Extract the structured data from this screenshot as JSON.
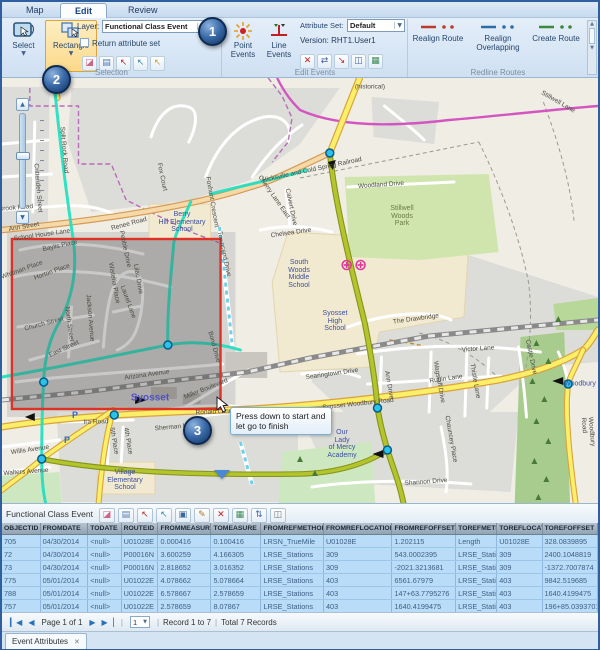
{
  "ribbon": {
    "tabs": [
      {
        "label": "Map"
      },
      {
        "label": "Edit"
      },
      {
        "label": "Review"
      }
    ],
    "select_label": "Select",
    "rectangle_label": "Rectangle",
    "layer_label": "Layer:",
    "layer_value": "Functional Class Event",
    "return_attribute_set": "Return attribute set",
    "selection_group": "Selection",
    "point_events_label": "Point Events",
    "line_events_label": "Line Events",
    "attribute_set_label": "Attribute Set:",
    "attribute_set_value": "Default",
    "version_label": "Version: RHT1.User1",
    "edit_events_group": "Edit Events",
    "selection_icons": [
      {
        "name": "clear-selection-icon",
        "glyph": "◪",
        "color": "#cc6688"
      },
      {
        "name": "attribute-table-icon",
        "glyph": "▤",
        "color": "#4a7ab0"
      },
      {
        "name": "select-by-attribute-icon",
        "glyph": "↖",
        "color": "#b03030"
      },
      {
        "name": "select-by-location-icon",
        "glyph": "↖",
        "color": "#3388aa"
      },
      {
        "name": "selection-options-icon",
        "glyph": "↖",
        "color": "#caa030"
      }
    ],
    "edit_icons": [
      {
        "name": "split-event-icon",
        "glyph": "✕",
        "color": "#c02020"
      },
      {
        "name": "merge-event-icon",
        "glyph": "⇄",
        "color": "#4466aa"
      },
      {
        "name": "snap-event-icon",
        "glyph": "↘",
        "color": "#c02020"
      },
      {
        "name": "event-window-icon",
        "glyph": "◫",
        "color": "#4466aa"
      },
      {
        "name": "event-grid-icon",
        "glyph": "▦",
        "color": "#3a8a5a"
      }
    ],
    "redline": {
      "group": "Redline Routes",
      "items": [
        {
          "label": "Realign Route",
          "color": "#c0392b"
        },
        {
          "label": "Realign Overlapping",
          "color": "#2e6da4"
        },
        {
          "label": "Create Route",
          "color": "#3a8a3a"
        }
      ]
    }
  },
  "callouts": [
    {
      "n": "1"
    },
    {
      "n": "2"
    },
    {
      "n": "3"
    }
  ],
  "map": {
    "tooltip": "Press down to start and let go to finish",
    "place_labels": [
      {
        "text": "Syosset",
        "x": 148,
        "y": 320,
        "cls": "city"
      },
      {
        "text": "Berry\nHill Elementary\nSchool",
        "x": 180,
        "y": 144
      },
      {
        "text": "South\nWoods\nMiddle\nSchool",
        "x": 297,
        "y": 196
      },
      {
        "text": "Syosset\nHigh\nSchool",
        "x": 333,
        "y": 243
      },
      {
        "text": "Stillwell\nWoods\nPark",
        "x": 400,
        "y": 138,
        "cls": "park"
      },
      {
        "text": "Our\nLady\nof Mercy\nAcademy",
        "x": 340,
        "y": 366
      },
      {
        "text": "Village\nElementary\nSchool",
        "x": 123,
        "y": 402
      },
      {
        "text": "Woodbury",
        "x": 578,
        "y": 306
      },
      {
        "text": "P",
        "x": 73,
        "y": 337,
        "cls": "pk"
      },
      {
        "text": "P",
        "x": 65,
        "y": 362,
        "cls": "pk"
      }
    ],
    "street_labels": [
      {
        "text": "Fox Court",
        "x": 160,
        "y": 99,
        "rot": 78
      },
      {
        "text": "Foxhunt Crescent",
        "x": 210,
        "y": 124,
        "rot": 80
      },
      {
        "text": "Cherry Lane East",
        "x": 272,
        "y": 119,
        "rot": 55
      },
      {
        "text": "Pebble Drive",
        "x": 123,
        "y": 171,
        "rot": 78
      },
      {
        "text": "Renee Road",
        "x": 127,
        "y": 146,
        "rot": -15
      },
      {
        "text": "School House Lane",
        "x": 40,
        "y": 157,
        "rot": -8
      },
      {
        "text": "Ann Street",
        "x": 22,
        "y": 149,
        "rot": -10
      },
      {
        "text": "Crittenden Street",
        "x": 36,
        "y": 110,
        "rot": 85
      },
      {
        "text": "Brook Road",
        "x": 14,
        "y": 130,
        "rot": -5
      },
      {
        "text": "Baylis Place",
        "x": 58,
        "y": 168,
        "rot": -12
      },
      {
        "text": "Horton Place",
        "x": 50,
        "y": 194,
        "rot": -20
      },
      {
        "text": "Whitman Place",
        "x": 20,
        "y": 192,
        "rot": -20
      },
      {
        "text": "Church Street",
        "x": 42,
        "y": 246,
        "rot": -15
      },
      {
        "text": "North Street",
        "x": 67,
        "y": 246,
        "rot": 82
      },
      {
        "text": "East Street",
        "x": 62,
        "y": 271,
        "rot": -25
      },
      {
        "text": "Jackson Avenue",
        "x": 88,
        "y": 240,
        "rot": 85
      },
      {
        "text": "Wisteria Place",
        "x": 112,
        "y": 205,
        "rot": 80
      },
      {
        "text": "Lilac Drive",
        "x": 136,
        "y": 201,
        "rot": 80
      },
      {
        "text": "Laurel Lane",
        "x": 126,
        "y": 224,
        "rot": 70
      },
      {
        "text": "Arizona Avenue",
        "x": 145,
        "y": 297,
        "rot": -8
      },
      {
        "text": "Miller Boulevard",
        "x": 204,
        "y": 311,
        "rot": -22
      },
      {
        "text": "Bond Drive",
        "x": 212,
        "y": 269,
        "rot": 75
      },
      {
        "text": "Townsend Drive",
        "x": 222,
        "y": 176,
        "rot": 78
      },
      {
        "text": "Chelsea Drive",
        "x": 289,
        "y": 155,
        "rot": -8
      },
      {
        "text": "Calvert Drive",
        "x": 289,
        "y": 129,
        "rot": 78
      },
      {
        "text": "Woodland Drive",
        "x": 379,
        "y": 107,
        "rot": -4
      },
      {
        "text": "The Drawbridge",
        "x": 414,
        "y": 241,
        "rot": -8
      },
      {
        "text": "Victor Lane",
        "x": 476,
        "y": 271,
        "rot": -4
      },
      {
        "text": "Rubin Lane",
        "x": 444,
        "y": 301,
        "rot": -8
      },
      {
        "text": "Ann Drive",
        "x": 387,
        "y": 307,
        "rot": 80
      },
      {
        "text": "Wagstaff Drive",
        "x": 437,
        "y": 304,
        "rot": 80
      },
      {
        "text": "Thistle Lane",
        "x": 473,
        "y": 303,
        "rot": 80
      },
      {
        "text": "Castle Drive",
        "x": 529,
        "y": 279,
        "rot": 78
      },
      {
        "text": "Searingtown Drive",
        "x": 330,
        "y": 296,
        "rot": -8
      },
      {
        "text": "Syosset Woodbury Road",
        "x": 356,
        "y": 326,
        "rot": -6
      },
      {
        "text": "Shannon Drive",
        "x": 424,
        "y": 404,
        "rot": -4
      },
      {
        "text": "Chauncey Place",
        "x": 449,
        "y": 361,
        "rot": 80
      },
      {
        "text": "Willis Avenue",
        "x": 28,
        "y": 372,
        "rot": -8
      },
      {
        "text": "Walters Avenue",
        "x": 24,
        "y": 394,
        "rot": -4
      },
      {
        "text": "Ira Road",
        "x": 94,
        "y": 344,
        "rot": -2
      },
      {
        "text": "5th Place",
        "x": 112,
        "y": 363,
        "rot": 80
      },
      {
        "text": "4th Place",
        "x": 126,
        "y": 363,
        "rot": 80
      },
      {
        "text": "Sherman Lane",
        "x": 174,
        "y": 349,
        "rot": -5
      },
      {
        "text": "Ronald Lane",
        "x": 212,
        "y": 334,
        "rot": -3
      },
      {
        "text": "Hicksville and Cold Spring Railroad",
        "x": 310,
        "y": 92,
        "rot": -12
      },
      {
        "text": "(historical)",
        "x": 368,
        "y": 9,
        "rot": 0
      },
      {
        "text": "Stillwell Lane",
        "x": 556,
        "y": 24,
        "rot": 30
      },
      {
        "text": "Split Rock Road",
        "x": 62,
        "y": 72,
        "rot": 85
      },
      {
        "text": "Woodbury Road",
        "x": 586,
        "y": 354,
        "rot": 85
      }
    ]
  },
  "table": {
    "title": "Functional Class Event",
    "toolbar_icons": [
      {
        "name": "clear-selection-icon",
        "glyph": "◪",
        "color": "#cc6688"
      },
      {
        "name": "show-table-icon",
        "glyph": "▤",
        "color": "#4a7ab0"
      },
      {
        "name": "select-events-icon",
        "glyph": "↖",
        "color": "#b03030"
      },
      {
        "name": "select-add-icon",
        "glyph": "↖",
        "color": "#3388aa"
      },
      {
        "name": "save-icon",
        "glyph": "▣",
        "color": "#3a6a9a"
      },
      {
        "name": "edit-icon",
        "glyph": "✎",
        "color": "#b07a20"
      },
      {
        "name": "delete-icon",
        "glyph": "✕",
        "color": "#c02020"
      },
      {
        "name": "grid-icon",
        "glyph": "▦",
        "color": "#3a8a5a"
      },
      {
        "name": "sort-icon",
        "glyph": "⇅",
        "color": "#3a6ab0"
      },
      {
        "name": "export-icon",
        "glyph": "◫",
        "color": "#777777"
      }
    ],
    "columns": [
      "OBJECTID",
      "FROMDATE",
      "TODATE",
      "ROUTEID",
      "FROMMEASURE",
      "TOMEASURE",
      "FROMREFMETHOD",
      "FROMREFLOCATION",
      "FROMREFOFFSET",
      "TOREFMETHOD",
      "TOREFLOCATION",
      "TOREFOFFSET"
    ],
    "col_widths_pct": [
      6.4,
      8.0,
      5.6,
      6.2,
      8.9,
      8.4,
      10.5,
      11.5,
      10.7,
      6.9,
      7.6,
      9.3
    ],
    "rows": [
      [
        "705",
        "04/30/2014",
        "<null>",
        "U01028E",
        "0.000416",
        "0.100416",
        "LRSN_TrueMile",
        "U01028E",
        "1.202115",
        "Length",
        "U01028E",
        "328.0839895"
      ],
      [
        "72",
        "04/30/2014",
        "<null>",
        "P00016N",
        "3.600259",
        "4.166305",
        "LRSE_Stations",
        "309",
        "543.0002395",
        "LRSE_Stations",
        "309",
        "2400.1048819"
      ],
      [
        "73",
        "04/30/2014",
        "<null>",
        "P00016N",
        "2.818652",
        "3.016352",
        "LRSE_Stations",
        "309",
        "-2021.3213681",
        "LRSE_Stations",
        "309",
        "-1372.7007874"
      ],
      [
        "775",
        "05/01/2014",
        "<null>",
        "U01022E",
        "4.078662",
        "5.078664",
        "LRSE_Stations",
        "403",
        "6561.67979",
        "LRSE_Stations",
        "403",
        "9842.519685"
      ],
      [
        "788",
        "05/01/2014",
        "<null>",
        "U01022E",
        "6.578667",
        "2.578659",
        "LRSE_Stations",
        "403",
        "147+63.7795276",
        "LRSE_Stations",
        "403",
        "1640.4199475"
      ],
      [
        "757",
        "05/01/2014",
        "<null>",
        "U01022E",
        "2.578659",
        "8.07867",
        "LRSE_Stations",
        "403",
        "1640.4199475",
        "LRSE_Stations",
        "403",
        "196+85.0393701"
      ],
      [
        "774",
        "05/01/2014",
        "<null>",
        "U01022E",
        "9.07867",
        "4.078662",
        "LRSE_Stations",
        "403",
        "196+85.0393701",
        "LRSE_Stations",
        "403",
        "6561.67979"
      ]
    ],
    "pagination": {
      "page": "Page 1 of 1",
      "page_num": "1",
      "record": "Record 1 to 7",
      "total": "Total 7 Records"
    },
    "tab": "Event Attributes"
  }
}
